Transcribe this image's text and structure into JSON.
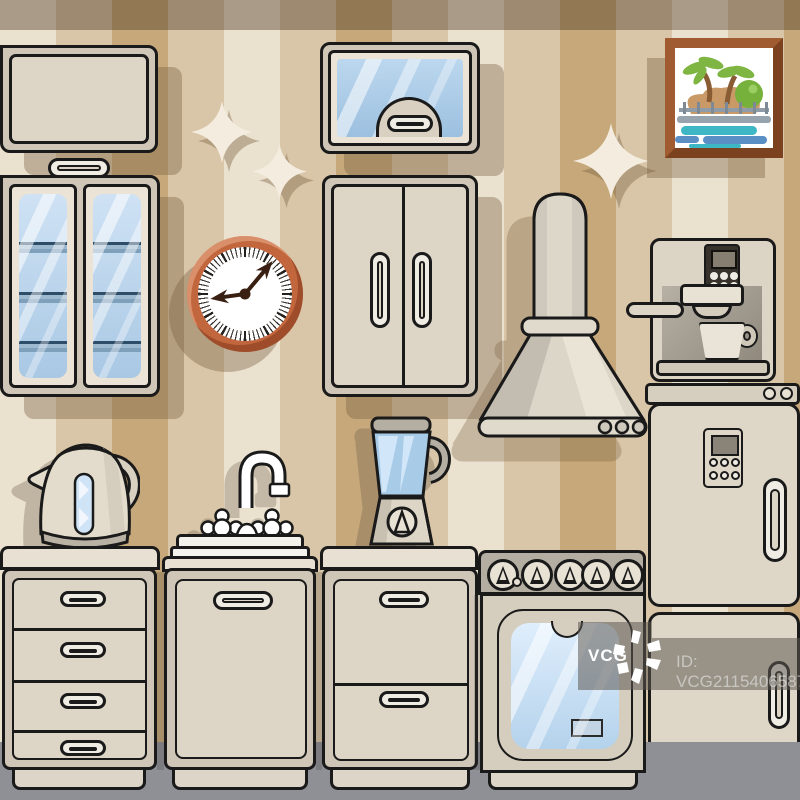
{
  "scene": {
    "description": "flat vector kitchen interior illustration"
  },
  "watermark": {
    "logo_text": "VCG",
    "id_text": "ID: VCG211540658702"
  },
  "clock": {
    "time_shown": "9:07"
  },
  "palette": {
    "wall_stripe_light": "#ebe1cf",
    "wall_stripe_mid": "#d9c6a8",
    "wall_stripe_dark": "#c6a87a",
    "ceiling_band": "rgba(62,42,22,0.38)",
    "cabinet_frame": "#cfc6b7",
    "cabinet_door": "#ddd5c6",
    "counter": "#e8e1d3",
    "outline": "#1a1a1a",
    "glass_blue": "#b9d4ec",
    "clock_frame": "#c2663e",
    "picture_frame_wood": "#9c5a2e",
    "floor": "#8f8f96",
    "watermark_overlay": "rgba(95,90,82,0.55)"
  },
  "icons": {
    "sparkle": "sparkle-icon",
    "vcg_star": "vcg-starburst-icon"
  },
  "objects": {
    "flip_wall_cabinet": "wall cabinet",
    "glass_cabinet": "glass display cabinet",
    "mirror_wall_cabinet": "glass-front wall cabinet",
    "double_door_cabinet": "two-door cabinet",
    "wall_clock": "wall clock",
    "picture": "seaside picture",
    "range_hood": "range hood",
    "coffee_machine": "espresso coffee machine",
    "fridge": "refrigerator",
    "kettle": "electric kettle",
    "sink": "sink with faucet",
    "blender": "blender",
    "stove": "stove with oven",
    "drawer_cabinet": "drawer cabinet"
  }
}
